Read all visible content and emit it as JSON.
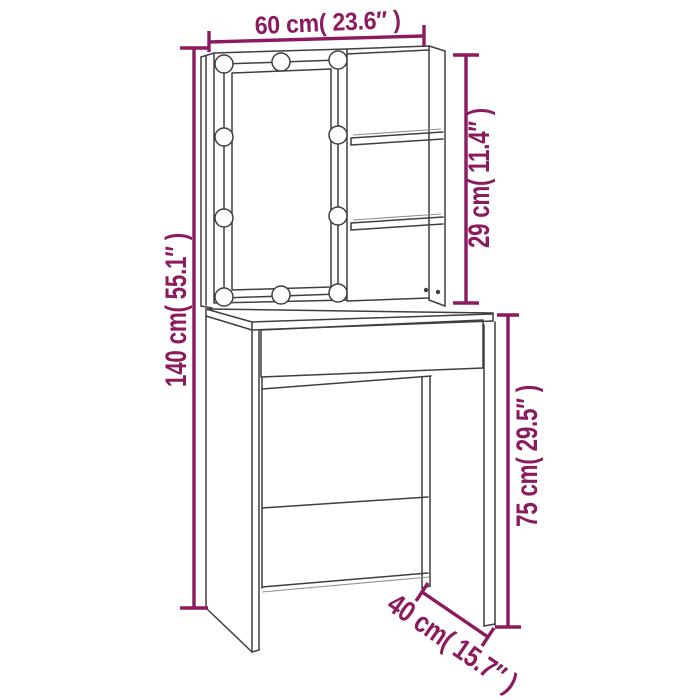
{
  "title": "Dressing table with LED mirror - dimension diagram",
  "style": {
    "dimension_color": "#8B1A5E",
    "line_color": "#3F3F3F",
    "background": "#FFFFFF"
  },
  "dimensions": {
    "width": {
      "label": "60 cm( 23.6″ )",
      "cm": 60,
      "inches": 23.6,
      "position": "top"
    },
    "upper_height": {
      "label": "29 cm( 11.4″ )",
      "cm": 29,
      "inches": 11.4,
      "position": "right-upper"
    },
    "total_height": {
      "label": "140 cm( 55.1″ )",
      "cm": 140,
      "inches": 55.1,
      "position": "left"
    },
    "table_height": {
      "label": "75 cm( 29.5″ )",
      "cm": 75,
      "inches": 29.5,
      "position": "right-lower"
    },
    "depth": {
      "label": "40 cm( 15.7″ )",
      "cm": 40,
      "inches": 15.7,
      "position": "bottom-diagonal"
    }
  },
  "features": {
    "led_bulb_count": 10,
    "side_shelf_count": 2,
    "drawer_count": 1
  }
}
